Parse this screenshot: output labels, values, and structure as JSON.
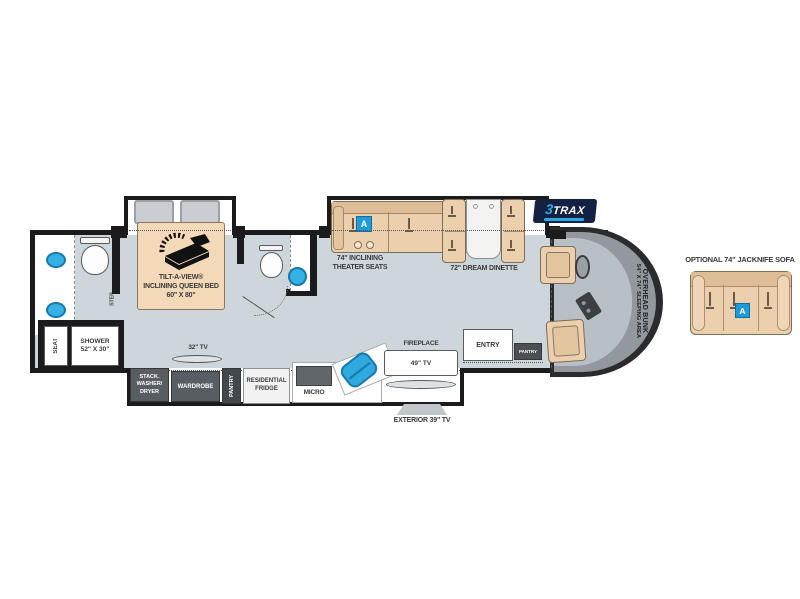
{
  "fp": {
    "rear_bath": {
      "seat": "SEAT",
      "shower": "SHOWER\n52\" X 30\"",
      "step": "STEP"
    },
    "bedroom": {
      "bed_label": "TILT-A-VIEW®\nINCLINING QUEEN BED\n60\" X 80\"",
      "tv32": "32\" TV"
    },
    "cabinets": {
      "washer": "STACK.\nWASHER/\nDRYER",
      "wardrobe": "WARDROBE",
      "pantry": "PANTRY"
    },
    "kitchen": {
      "fridge": "RESIDENTIAL\nFRIDGE",
      "micro": "MICRO",
      "fireplace": "FIREPLACE",
      "tv49": "49\" TV",
      "exterior_tv": "EXTERIOR 39\" TV"
    },
    "living": {
      "theater": "74\" INCLINING\nTHEATER SEATS",
      "dinette": "72\" DREAM DINETTE",
      "badge": "A"
    },
    "entry": {
      "entry": "ENTRY",
      "pantry": "PANTRY"
    },
    "cab": {
      "bunk1": "OVERHEAD BUNK",
      "bunk2": "54\" X 74\" SLEEPING AREA"
    },
    "logo": {
      "three": "3",
      "trax": "TRAX"
    },
    "sofa": {
      "label": "OPTIONAL 74\" JACKNIFE SOFA",
      "badge": "A"
    }
  },
  "colors": {
    "wall": "#1b1b1d",
    "floor": "#cdd6db",
    "tan": "#ecd0ae",
    "accent_blue": "#2fa9e0",
    "badge_blue": "#1e9cd8",
    "logo_navy": "#132144"
  }
}
